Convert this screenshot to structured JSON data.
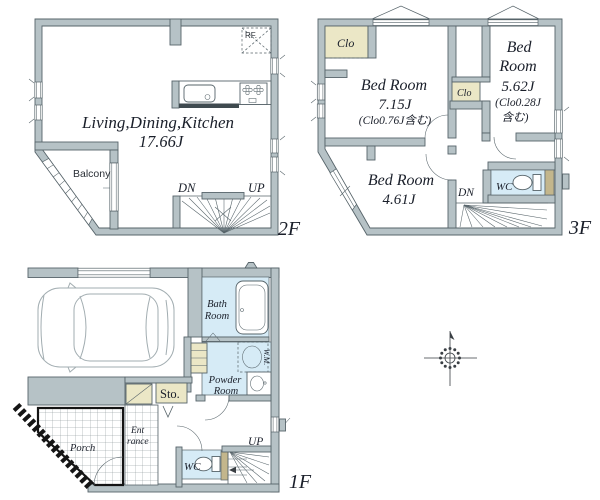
{
  "colors": {
    "wall": "#b6c2c6",
    "wall_outline": "#57646a",
    "closet_fill": "#ebe7c6",
    "water_fill": "#d6ebf6",
    "text": "#1a1f2a"
  },
  "floor2": {
    "floor_label": "2F",
    "ldk_name": "Living,Dining,Kitchen",
    "ldk_area": "17.66J",
    "balcony_label": "Balcony",
    "rf_label": "RF.",
    "dn_label": "DN",
    "up_label": "UP"
  },
  "floor3": {
    "floor_label": "3F",
    "bedroom1_name": "Bed Room",
    "bedroom1_area": "7.15J",
    "bedroom1_note": "(Clo0.76J含む)",
    "bedroom2_name_l1": "Bed",
    "bedroom2_name_l2": "Room",
    "bedroom2_area": "5.62J",
    "bedroom2_note_l1": "(Clo0.28J",
    "bedroom2_note_l2": "含む)",
    "bedroom3_name": "Bed Room",
    "bedroom3_area": "4.61J",
    "closet_a_label": "Clo",
    "closet_b_label": "Clo",
    "wc_label": "WC",
    "dn_label": "DN"
  },
  "floor1": {
    "floor_label": "1F",
    "bath_l1": "Bath",
    "bath_l2": "Room",
    "powder_l1": "Powder",
    "powder_l2": "Room",
    "wm_label": "W.M.",
    "storage_label": "Sto.",
    "porch_label": "Porch",
    "entrance_l1": "Ent",
    "entrance_l2": "rance",
    "wc_label": "WC",
    "up_label": "UP"
  }
}
